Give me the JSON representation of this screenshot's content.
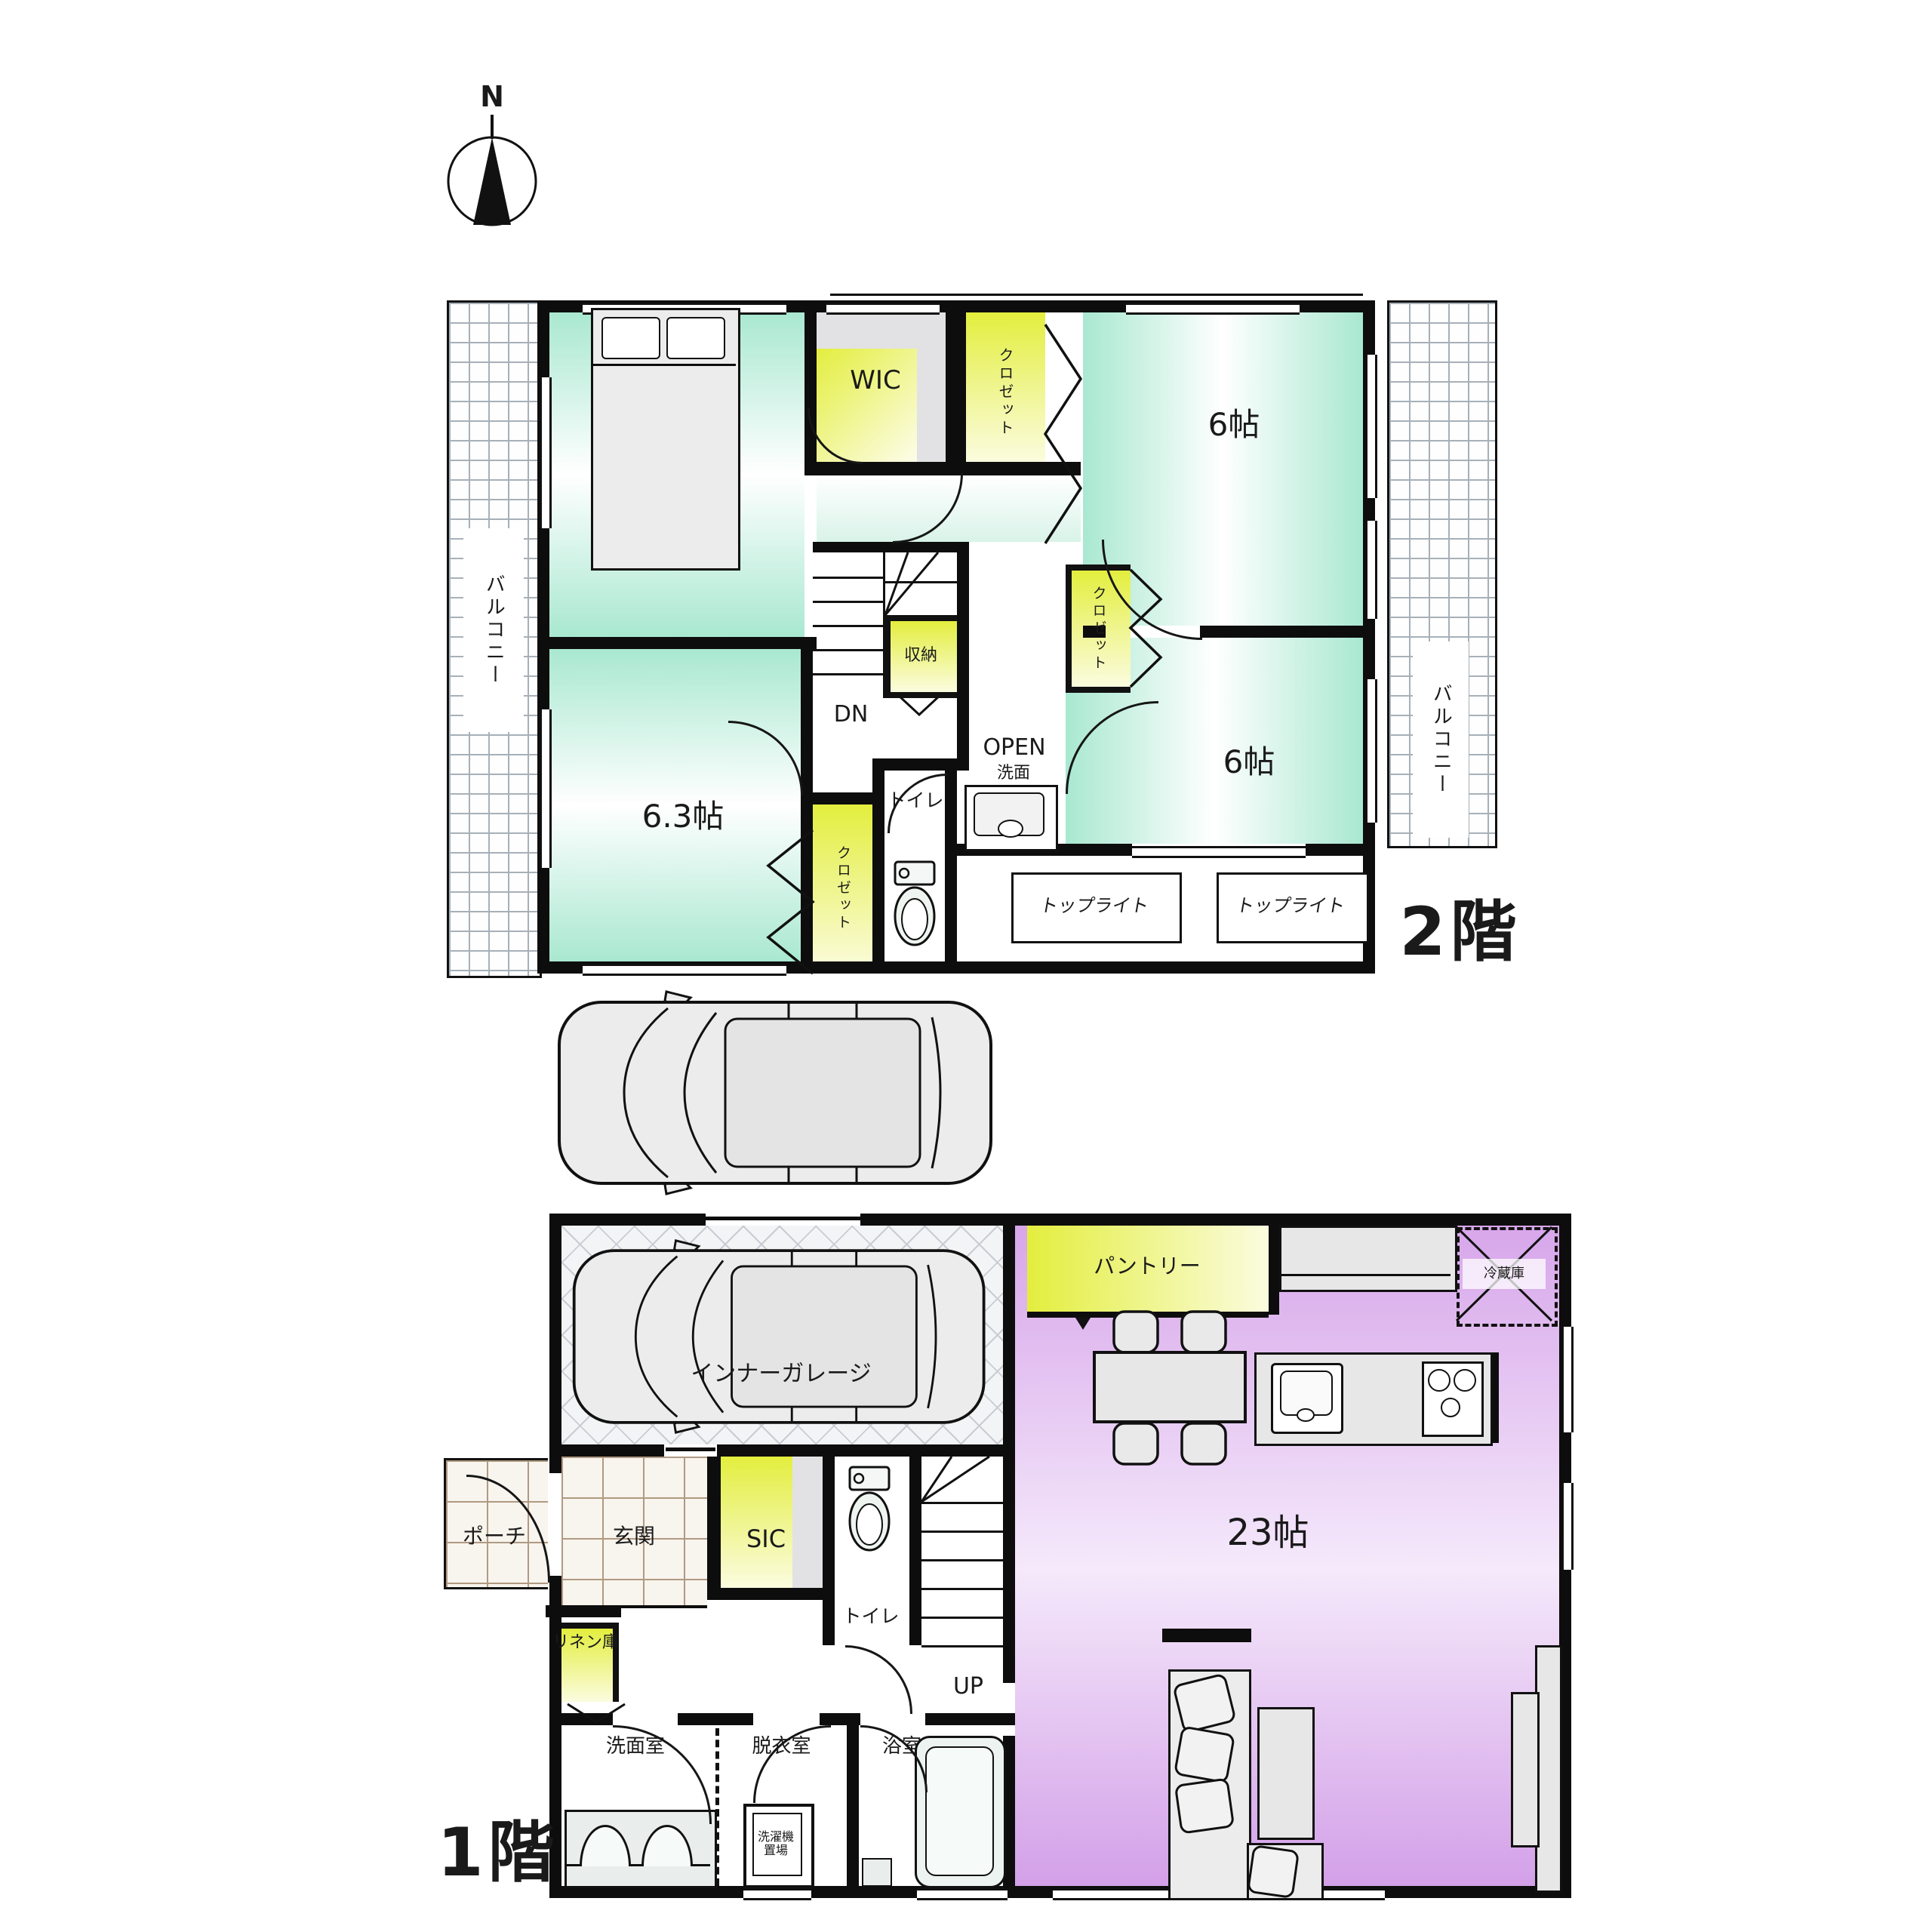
{
  "compass": {
    "north": "N"
  },
  "floor2": {
    "title": "2階",
    "balcony": "バルコニー",
    "bedroom1_size": "7.6帖",
    "bedroom2_size": "6帖",
    "bedroom3_size": "6帖",
    "bedroom4_size": "6.3帖",
    "wic": "WIC",
    "closet": "クロゼット",
    "storage": "収納",
    "stairs_dn": "DN",
    "toilet": "トイレ",
    "open": "OPEN",
    "washbasin": "洗面",
    "skylight": "トップライト"
  },
  "floor1": {
    "title": "1階",
    "garage": "インナーガレージ",
    "pantry": "パントリー",
    "fridge": "冷蔵庫",
    "ldk_size": "23帖",
    "porch": "ポーチ",
    "entrance": "玄関",
    "sic": "SIC",
    "toilet": "トイレ",
    "stairs_up": "UP",
    "linen": "リネン庫",
    "washroom": "洗面室",
    "dressing": "脱衣室",
    "bathroom": "浴室",
    "washer": "洗濯機置場"
  },
  "colors": {
    "room_teal": "#a9e8d1",
    "closet_yellow": "#e3ee3e",
    "ldk_purple": "#d7a6ea",
    "wall": "#0d0d0d"
  }
}
